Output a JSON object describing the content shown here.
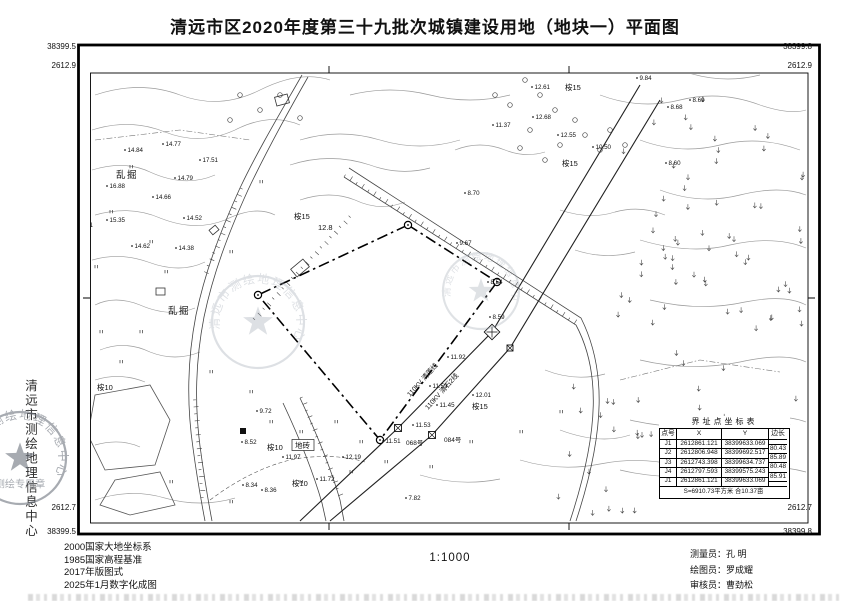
{
  "title": "清远市区2020年度第三十九批次城镇建设用地（地块一）平面图",
  "scale_text": "1:1000",
  "frame_labels": {
    "tl_x": "38399.5",
    "tl_y": "2612.9",
    "tr_x": "38399.8",
    "tr_y": "2612.9",
    "bl_y": "2612.7",
    "bl_x": "38399.5",
    "br_y": "2612.7",
    "br_x": "38399.8"
  },
  "left_margin": {
    "org_name": "清远市测绘地理信息中心",
    "seal_arc_text": "清远市测绘地理信息中心",
    "seal_center_text": "测绘专用章"
  },
  "notes": [
    "2000国家大地坐标系",
    "1985国家高程基准",
    "2017年版图式",
    "2025年1月数字化成图"
  ],
  "credits": [
    {
      "label": "测量员：",
      "name": "孔  明"
    },
    {
      "label": "绘图员：",
      "name": "罗成耀"
    },
    {
      "label": "审核员：",
      "name": "曹劲松"
    }
  ],
  "coord_table": {
    "title": "界址点坐标表",
    "headers": [
      "点号",
      "X",
      "Y",
      "边长"
    ],
    "points": [
      {
        "id": "J1",
        "x": "2612861.121",
        "y": "38399633.069"
      },
      {
        "id": "J2",
        "x": "2612806.948",
        "y": "38399692.517"
      },
      {
        "id": "J3",
        "x": "2612743.398",
        "y": "38399634.737"
      },
      {
        "id": "J4",
        "x": "2612797.593",
        "y": "38399575.243"
      },
      {
        "id": "J1",
        "x": "2612861.121",
        "y": "38399633.069"
      }
    ],
    "side_lengths": [
      "80.43",
      "85.89",
      "80.48",
      "85.91"
    ],
    "area_note": "S=6910.73平方米 合10.37亩"
  },
  "map_labels": {
    "power_lines": [
      "110KV 清莲线",
      "110KV 清石2线"
    ],
    "poles": [
      "068号",
      "084号"
    ],
    "features": [
      {
        "t": "乱掘",
        "x": 116,
        "y": 178,
        "big": true
      },
      {
        "t": "乱掘",
        "x": 168,
        "y": 314,
        "big": true
      },
      {
        "t": "桉15",
        "x": 565,
        "y": 90
      },
      {
        "t": "桉15",
        "x": 562,
        "y": 166
      },
      {
        "t": "桉15",
        "x": 472,
        "y": 409
      },
      {
        "t": "桉15",
        "x": 294,
        "y": 219
      },
      {
        "t": "桉10",
        "x": 97,
        "y": 390
      },
      {
        "t": "桉10",
        "x": 267,
        "y": 450
      },
      {
        "t": "桉10",
        "x": 292,
        "y": 486
      },
      {
        "t": "12.8",
        "x": 318,
        "y": 230
      },
      {
        "t": "地砖",
        "x": 295,
        "y": 448,
        "boxed": true
      }
    ],
    "spots": [
      [
        66,
        163,
        "15.11"
      ],
      [
        125,
        150,
        "14.84"
      ],
      [
        163,
        144,
        "14.77"
      ],
      [
        200,
        160,
        "17.51"
      ],
      [
        175,
        178,
        "14.79"
      ],
      [
        107,
        186,
        "16.88"
      ],
      [
        153,
        197,
        "14.66"
      ],
      [
        184,
        218,
        "14.52"
      ],
      [
        107,
        220,
        "15.35"
      ],
      [
        75,
        225,
        "15.21"
      ],
      [
        132,
        246,
        "14.62"
      ],
      [
        176,
        248,
        "14.38"
      ],
      [
        585,
        70,
        "12.12"
      ],
      [
        637,
        78,
        "9.84"
      ],
      [
        532,
        87,
        "12.61"
      ],
      [
        533,
        117,
        "12.68"
      ],
      [
        493,
        125,
        "11.37"
      ],
      [
        558,
        135,
        "12.55"
      ],
      [
        593,
        147,
        "10.50"
      ],
      [
        668,
        107,
        "8.68"
      ],
      [
        666,
        163,
        "8.60"
      ],
      [
        690,
        100,
        "8.69"
      ],
      [
        465,
        193,
        "8.70"
      ],
      [
        448,
        357,
        "11.92"
      ],
      [
        430,
        386,
        "11.59"
      ],
      [
        437,
        405,
        "11.45"
      ],
      [
        473,
        395,
        "12.01"
      ],
      [
        413,
        425,
        "11.53"
      ],
      [
        383,
        441,
        "11.51"
      ],
      [
        457,
        243,
        "9.67"
      ],
      [
        488,
        282,
        "8.54"
      ],
      [
        490,
        317,
        "8.59"
      ],
      [
        257,
        411,
        "9.72"
      ],
      [
        242,
        442,
        "8.52"
      ],
      [
        283,
        457,
        "11.97"
      ],
      [
        343,
        457,
        "12.19"
      ],
      [
        243,
        485,
        "8.34"
      ],
      [
        262,
        490,
        "8.36"
      ],
      [
        317,
        479,
        "11.72"
      ],
      [
        406,
        498,
        "7.82"
      ]
    ]
  }
}
